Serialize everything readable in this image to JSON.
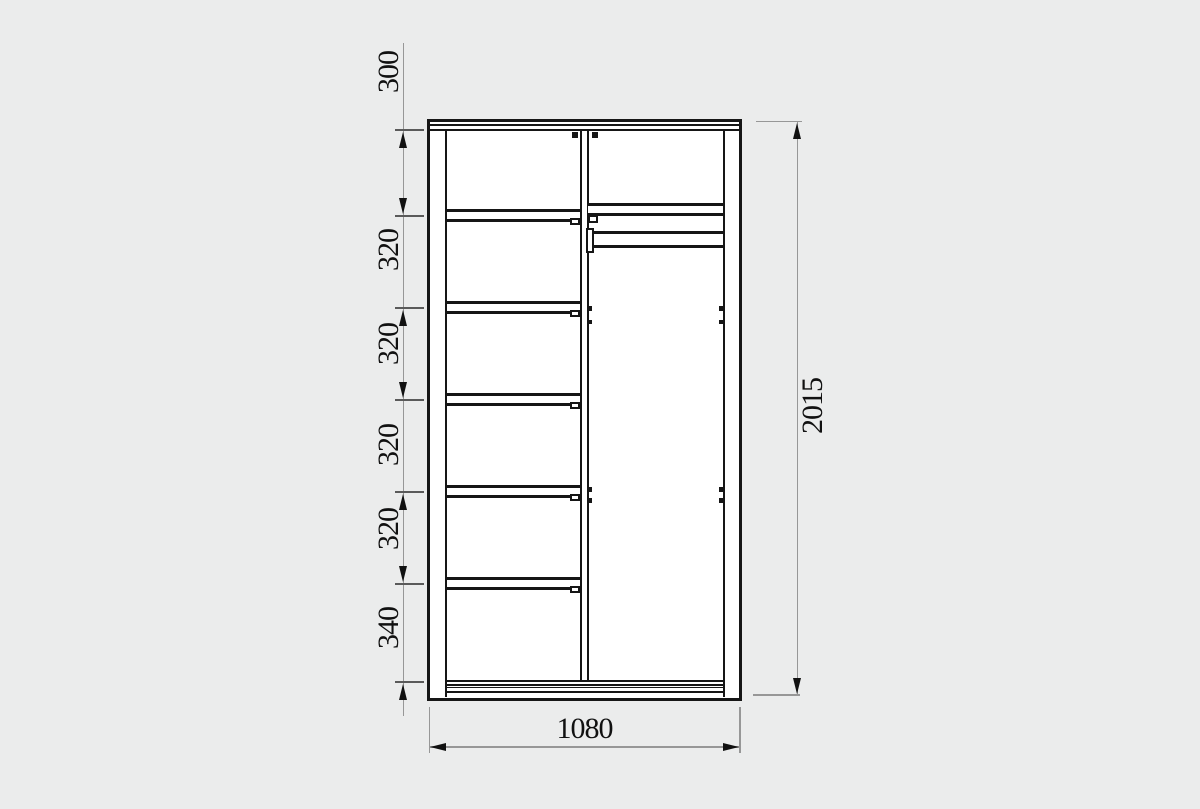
{
  "drawing_type": "furniture dimension drawing (wardrobe front section)",
  "colors": {
    "background": "#ebecec",
    "furniture_line": "#161616",
    "dimension_line": "#979797",
    "text": "#111111"
  },
  "dims": {
    "left_chain": [
      "300",
      "320",
      "320",
      "320",
      "320",
      "340"
    ],
    "height": "2015",
    "width": "1080"
  }
}
